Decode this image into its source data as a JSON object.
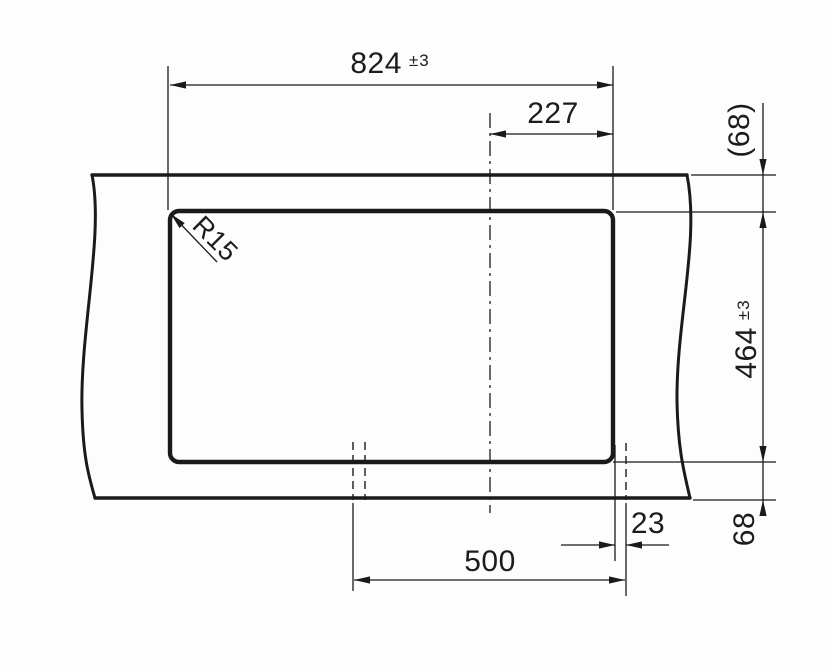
{
  "drawing": {
    "background": "#fdfdfd",
    "line_color": "#1a1a1a",
    "dimensions": {
      "overall_width": {
        "value": "824",
        "tolerance": "±3"
      },
      "centerline_to_right_edge": {
        "value": "227"
      },
      "panel_to_cutout_top": {
        "value": "(68)"
      },
      "cutout_height": {
        "value": "464",
        "tolerance": "±3"
      },
      "cutout_to_panel_bottom": {
        "value": "68"
      },
      "cutout_edge_to_bowl": {
        "value": "23"
      },
      "bowl_width": {
        "value": "500"
      },
      "corner_radius": {
        "value": "R15"
      }
    }
  }
}
